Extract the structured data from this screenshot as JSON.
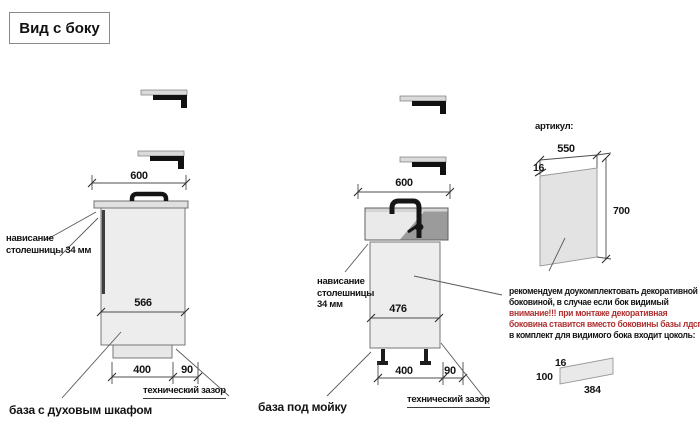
{
  "title": "Вид с боку",
  "colors": {
    "warning_text": "#b03030"
  },
  "oven_base": {
    "label": "база с духовым шкафом",
    "top_width": "600",
    "inner_depth": "566",
    "plinth_depth": "400",
    "tech_gap": "90",
    "tech_gap_label": "технический зазор",
    "overhang_label": [
      "нависание",
      "столешницы 34 мм"
    ]
  },
  "sink_base": {
    "label": "база под мойку",
    "top_width": "600",
    "inner_depth": "476",
    "plinth_depth": "400",
    "tech_gap": "90",
    "tech_gap_label": "технический зазор",
    "overhang_label": [
      "нависание",
      "столешницы",
      "34 мм"
    ]
  },
  "decor_panel": {
    "article_label": "артикул:",
    "width": "550",
    "thickness": "16",
    "height": "700",
    "note_lines": [
      "рекомендуем доукомплектовать декоративной",
      "боковиной, в случае если бок видимый"
    ],
    "warning_lines": [
      "внимание!!! при монтаже декоративная",
      "боковина ставится вместо боковины базы лдсп"
    ],
    "note_tail": "в комплект для видимого бока входит цоколь:"
  },
  "plinth_strip": {
    "thickness": "16",
    "height": "100",
    "length": "384"
  }
}
